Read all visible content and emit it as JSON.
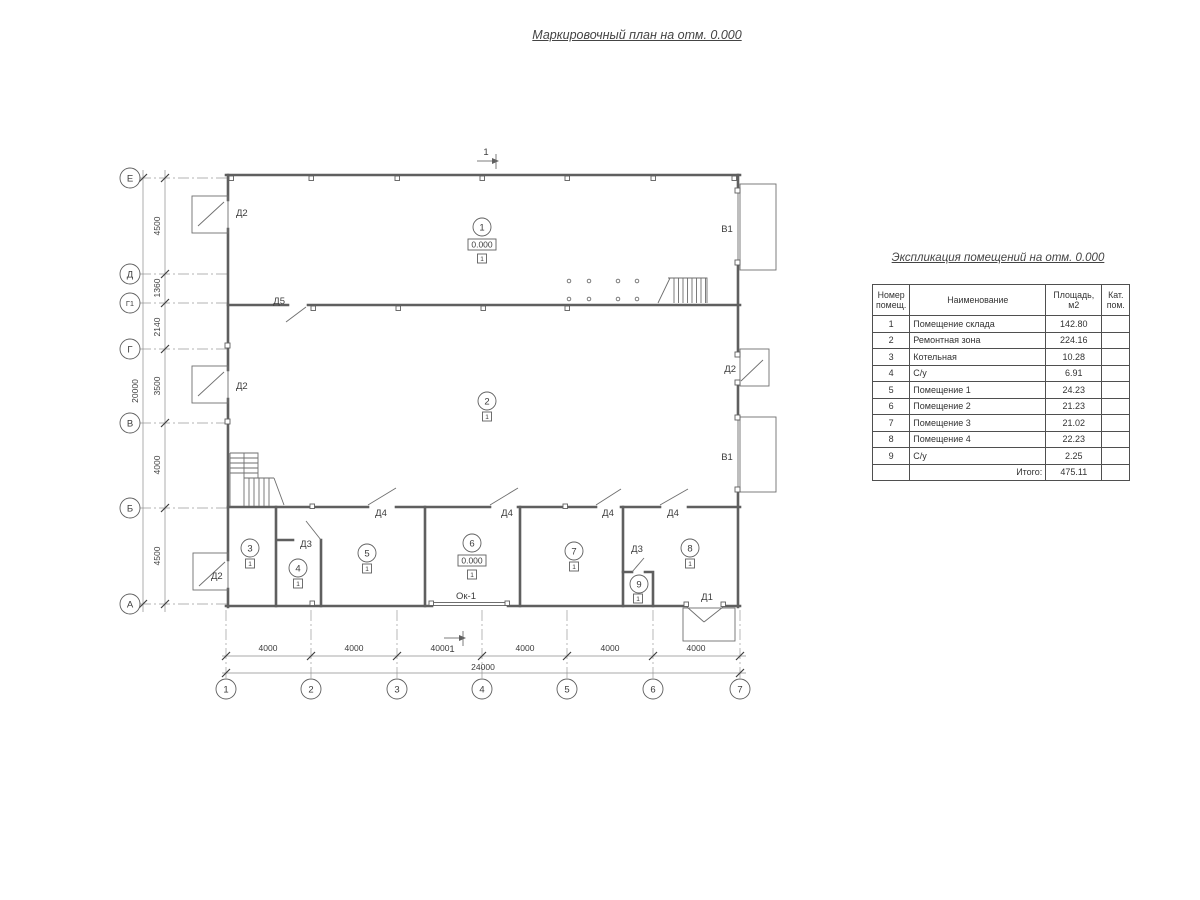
{
  "drawing_title": "Маркировочный план на отм. 0.000",
  "plan": {
    "row_axes": [
      "Е",
      "Д",
      "Г1",
      "Г",
      "В",
      "Б",
      "А"
    ],
    "col_axes": [
      "1",
      "2",
      "3",
      "4",
      "5",
      "6",
      "7"
    ],
    "dims_left": [
      "4500",
      "1360",
      "2140",
      "3500",
      "4000",
      "4500"
    ],
    "dim_left_total": "20000",
    "dims_bottom": [
      "4000",
      "4000",
      "4000",
      "4000",
      "4000",
      "4000"
    ],
    "dim_bottom_total": "24000",
    "room_numbers": [
      "1",
      "2",
      "3",
      "4",
      "5",
      "6",
      "7",
      "8",
      "9"
    ],
    "floor_mark": "1",
    "elevation_mark": "0.000",
    "section_mark": "1",
    "labels": {
      "d1": "Д1",
      "d2": "Д2",
      "d3": "Д3",
      "d4": "Д4",
      "d5": "Д5",
      "v1": "В1",
      "window": "Ок-1"
    }
  },
  "schedule": {
    "title": "Экспликация помещений на отм. 0.000",
    "headers": {
      "num": "Номер помещ.",
      "name": "Наименование",
      "area": "Площадь, м2",
      "cat": "Кат. пом."
    },
    "rows": [
      {
        "num": "1",
        "name": "Помещение склада",
        "area": "142.80",
        "cat": ""
      },
      {
        "num": "2",
        "name": "Ремонтная зона",
        "area": "224.16",
        "cat": ""
      },
      {
        "num": "3",
        "name": "Котельная",
        "area": "10.28",
        "cat": ""
      },
      {
        "num": "4",
        "name": "С/у",
        "area": "6.91",
        "cat": ""
      },
      {
        "num": "5",
        "name": "Помещение 1",
        "area": "24.23",
        "cat": ""
      },
      {
        "num": "6",
        "name": "Помещение 2",
        "area": "21.23",
        "cat": ""
      },
      {
        "num": "7",
        "name": "Помещение 3",
        "area": "21.02",
        "cat": ""
      },
      {
        "num": "8",
        "name": "Помещение 4",
        "area": "22.23",
        "cat": ""
      },
      {
        "num": "9",
        "name": "С/у",
        "area": "2.25",
        "cat": ""
      }
    ],
    "total_label": "Итого:",
    "total_value": "475.11"
  }
}
